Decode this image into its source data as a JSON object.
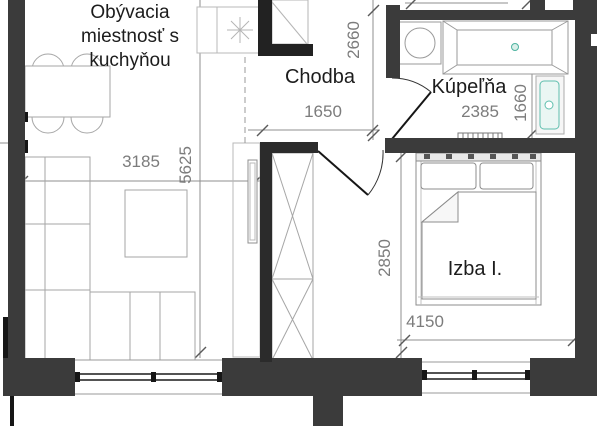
{
  "plan_title": "apartment floor plan",
  "rooms": {
    "living": {
      "line1": "Obývacia",
      "line2": "miestnosť s",
      "line3": "kuchyňou"
    },
    "hall": {
      "label": "Chodba"
    },
    "bath": {
      "label": "Kúpeľňa"
    },
    "bedroom": {
      "label": "Izba I."
    }
  },
  "dimensions": {
    "living_width": "3185",
    "living_depth": "5625",
    "hall_width": "1650",
    "hall_depth": "2660",
    "bath_width": "2385",
    "bath_niche": "1660",
    "bedroom_depth": "2850",
    "bedroom_width": "4150"
  },
  "colors": {
    "wall": "#3b3b3b",
    "thin_wall": "#161616",
    "furniture_line": "#a6a6a6",
    "fixture_line": "#9a9a9a",
    "dimension_text": "#7c7c7c",
    "accent_teal": "#5fbfae",
    "background": "#ffffff"
  },
  "fixtures": [
    "dining-table",
    "chairs",
    "kitchen-counter",
    "stove",
    "sofa",
    "coffee-table",
    "tv-board",
    "hall-closet",
    "wardrobe",
    "double-bed",
    "washing-machine",
    "bathtub",
    "shower-unit",
    "radiator",
    "window",
    "door"
  ]
}
